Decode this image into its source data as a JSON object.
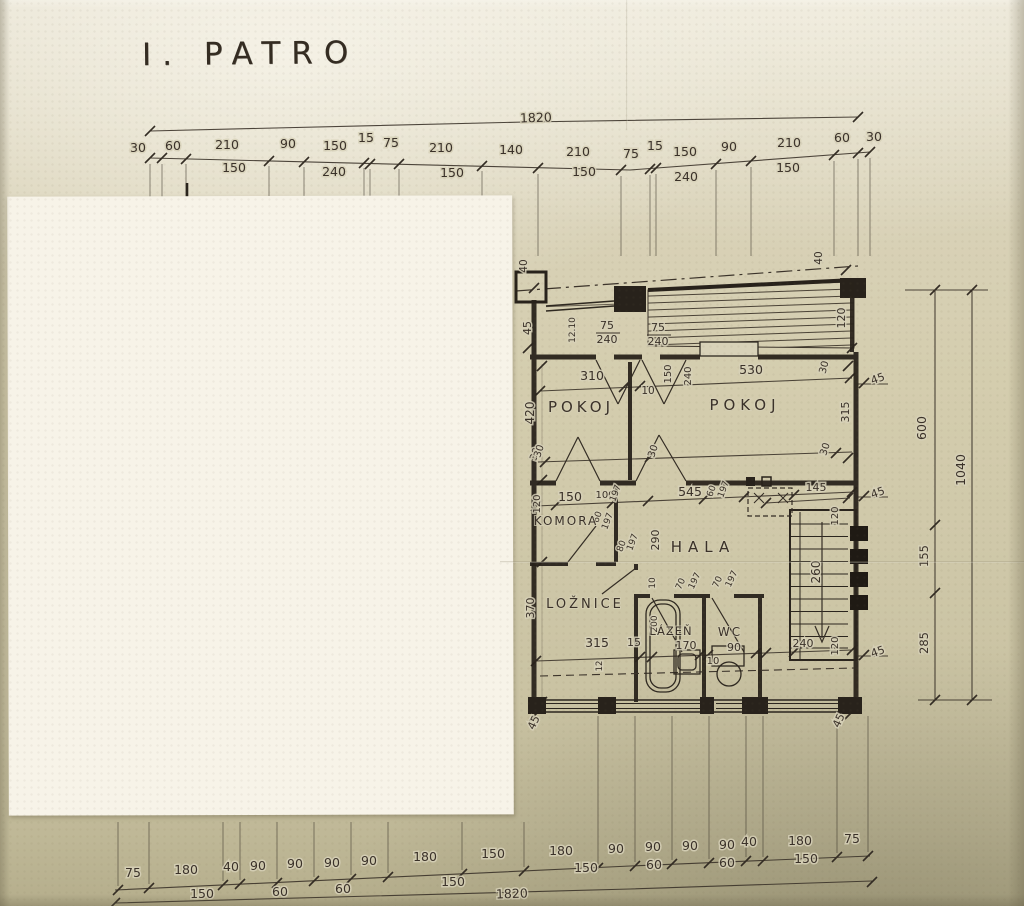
{
  "title": "I. PATRO",
  "top_chain": {
    "total": "1820",
    "row1": [
      "30",
      "60",
      "210",
      "90",
      "150",
      "15",
      "75",
      "210",
      "140",
      "210",
      "75",
      "15",
      "150",
      "90",
      "210",
      "60",
      "30"
    ],
    "row2": [
      "150",
      "240",
      "150",
      "150",
      "240",
      "150"
    ]
  },
  "bottom_chain": {
    "total": "1820",
    "row1": [
      "75",
      "180",
      "40",
      "90",
      "90",
      "90",
      "90",
      "180",
      "150",
      "180",
      "90",
      "90",
      "90",
      "90",
      "40",
      "180",
      "75"
    ],
    "row2": [
      "150",
      "60",
      "60",
      "150",
      "150",
      "60",
      "60",
      "150"
    ]
  },
  "right_chain": {
    "segments": [
      "600",
      "155",
      "285"
    ],
    "total": "1040"
  },
  "rooms": {
    "pokoj1": "POKOJ",
    "pokoj2": "POKOJ",
    "hala": "HALA",
    "komora": "KOMORA",
    "loznice": "LOŽNICE",
    "lazen": "LÁZEŇ",
    "wc": "WC"
  },
  "dims": {
    "d310": "310",
    "d530": "530",
    "d10a": "10",
    "t40a": "40",
    "t40b": "40",
    "bal120": "120",
    "l45a": "45",
    "l420": "420",
    "l30": "30",
    "l120": "120",
    "l370": "370",
    "b45a": "45",
    "b45b": "45",
    "r30a": "30",
    "r315": "315",
    "r45a": "45",
    "r45b": "45",
    "r45c": "45",
    "m30a": "30",
    "m30b": "30",
    "m30c": "30",
    "d75a": "75",
    "d240a": "240",
    "d75b": "75",
    "d240b": "240",
    "w150": "150",
    "w240": "240",
    "note1": "12.10",
    "note2": "12",
    "k150": "150",
    "k100": "100",
    "k197a": "197",
    "k60": "60",
    "k197b": "197",
    "k80": "80",
    "k197c": "197",
    "h545": "545",
    "h60": "60",
    "h197": "197",
    "h290": "290",
    "h10": "10",
    "door70a": "70",
    "door197a": "197",
    "door70b": "70",
    "door197b": "197",
    "laz170": "170",
    "wc90": "90",
    "wc10": "10",
    "tub200": "200",
    "loz315": "315",
    "loz15": "15",
    "s145": "145",
    "s120a": "120",
    "s260": "260",
    "s240": "240",
    "s120b": "120"
  }
}
